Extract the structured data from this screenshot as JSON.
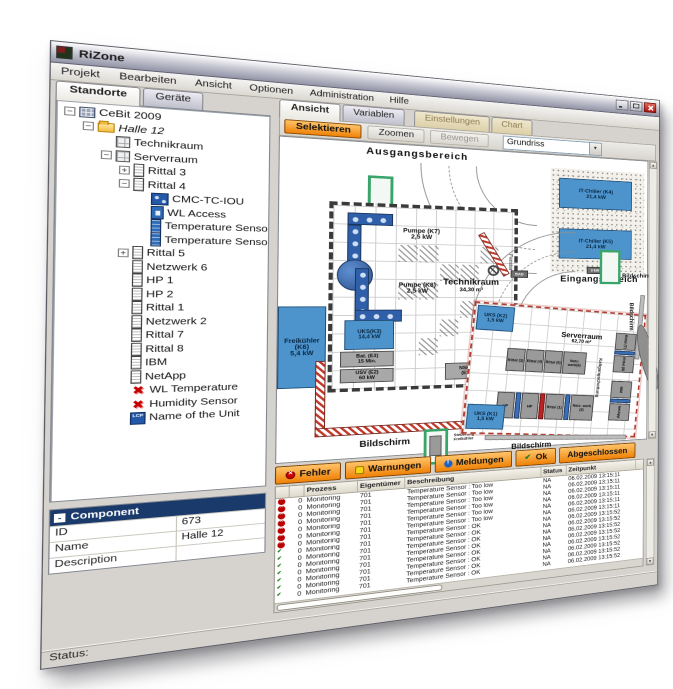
{
  "window": {
    "title": "RiZone",
    "controls": [
      "minimize-icon",
      "maximize-icon",
      "close-icon"
    ]
  },
  "menu": {
    "items": [
      "Projekt",
      "Bearbeiten",
      "Ansicht",
      "Optionen",
      "Administration",
      "Hilfe"
    ]
  },
  "left_tabs": [
    {
      "label": "Standorte"
    },
    {
      "label": "Geräte"
    }
  ],
  "tree": {
    "items": [
      {
        "label": "CeBit 2009",
        "depth": 0,
        "expander": "-",
        "icon": "site"
      },
      {
        "label": "Halle 12",
        "depth": 1,
        "expander": "-",
        "icon": "folder",
        "italic": true
      },
      {
        "label": "Technikraum",
        "depth": 2,
        "expander": null,
        "icon": "room"
      },
      {
        "label": "Serverraum",
        "depth": 2,
        "expander": "-",
        "icon": "room"
      },
      {
        "label": "Rittal 3",
        "depth": 3,
        "expander": "+",
        "icon": "rack"
      },
      {
        "label": "Rittal 4",
        "depth": 3,
        "expander": "-",
        "icon": "rack"
      },
      {
        "label": "CMC-TC-IOU",
        "depth": 4,
        "expander": null,
        "icon": "devcmc"
      },
      {
        "label": "WL Access",
        "depth": 4,
        "expander": null,
        "icon": "devwl"
      },
      {
        "label": "Temperature Sensor",
        "depth": 4,
        "expander": null,
        "icon": "devsensor"
      },
      {
        "label": "Temperature Sensor",
        "depth": 4,
        "expander": null,
        "icon": "devsensor"
      },
      {
        "label": "Rittal 5",
        "depth": 3,
        "expander": "+",
        "icon": "rack"
      },
      {
        "label": "Netzwerk 6",
        "depth": 3,
        "expander": null,
        "icon": "rack"
      },
      {
        "label": "HP 1",
        "depth": 3,
        "expander": null,
        "icon": "rack"
      },
      {
        "label": "HP 2",
        "depth": 3,
        "expander": null,
        "icon": "rack"
      },
      {
        "label": "Rittal 1",
        "depth": 3,
        "expander": null,
        "icon": "rack"
      },
      {
        "label": "Netzwerk 2",
        "depth": 3,
        "expander": null,
        "icon": "rack"
      },
      {
        "label": "Rittal 7",
        "depth": 3,
        "expander": null,
        "icon": "rack"
      },
      {
        "label": "Rittal 8",
        "depth": 3,
        "expander": null,
        "icon": "rack"
      },
      {
        "label": "IBM",
        "depth": 3,
        "expander": null,
        "icon": "rack"
      },
      {
        "label": "NetApp",
        "depth": 3,
        "expander": null,
        "icon": "rack"
      },
      {
        "label": "WL Temperature",
        "depth": 3,
        "expander": null,
        "icon": "redx"
      },
      {
        "label": "Humidity Sensor",
        "depth": 3,
        "expander": null,
        "icon": "redx"
      },
      {
        "label": "Name of the Unit",
        "depth": 3,
        "expander": null,
        "icon": "lcp"
      }
    ]
  },
  "properties": {
    "header": "Component",
    "collapse_glyph": "-",
    "rows": [
      {
        "label": "ID",
        "value": "673"
      },
      {
        "label": "Name",
        "value": "Halle 12"
      },
      {
        "label": "Description",
        "value": ""
      }
    ]
  },
  "right_tabs": [
    {
      "label": "Ansicht",
      "state": "active"
    },
    {
      "label": "Variablen",
      "state": "normal"
    },
    {
      "label": "Einstellungen",
      "state": "disabled"
    },
    {
      "label": "Chart",
      "state": "disabled"
    }
  ],
  "toolbar": {
    "selektieren": "Selektieren",
    "zoomen": "Zoomen",
    "bewegen": "Bewegen",
    "view_select": "Grundriss"
  },
  "plan": {
    "areas": {
      "ausgang": "Ausgangsbereich",
      "eingang": "Eingangsbereich"
    },
    "technikraum": {
      "name": "Technikraum",
      "size": "34,30 m²"
    },
    "serverraum": {
      "name": "Serverraum",
      "size": "62,70 m²"
    },
    "units": {
      "k7": "Pumpe (K7)\n2,5 kW",
      "k8": "Pumpe (K8)\n2,5 kW",
      "k3": "UKS(K3)\n14,4 kW",
      "k6": "Freikühler\n(K6)\n5,4 kW",
      "k4": "IT-Chiller (K4)\n21,4 kW",
      "k5": "IT-Chiller (K5)\n21,4 kW",
      "k2": "UKS (K2)\n1,5 kW",
      "k1": "UKS (K1)\n1,5 kW",
      "e3": "Bat. (E3)\n15 Min.",
      "e2": "USV (E2)\n60 kW",
      "e1": "NSHV\n(E1)",
      "e4": "PDR\n(E4)"
    },
    "racks": {
      "r3": "Rittal (3)",
      "r4": "Rittal (4)",
      "r5": "Rittal (5)",
      "n6": "Netz- werk(6)",
      "hp1": "HP",
      "hp2": "HP",
      "r1": "Rittal (1)",
      "n2": "Netz- werk (2)",
      "r7": "Rittal (7)",
      "r8": "Rittal (8)",
      "ibm": "IBM",
      "netapp": "NetApp"
    },
    "labels": {
      "bildschirm1": "Bildschirm",
      "bildschirm2": "Bildschirm",
      "bildschirm3": "Bildschirm",
      "bildschirm4": "Bildschirm",
      "fenster": "Fenster",
      "kaltgang": "Kaltgangschottung",
      "steuerung": "Steuerung\nFreikühler",
      "infostand": "Info-Stand",
      "chip1": "BAD",
      "chip2": "3 kW"
    }
  },
  "events": {
    "buttons": [
      {
        "label": "Fehler",
        "icon": "error-icon"
      },
      {
        "label": "Warnungen",
        "icon": "warning-icon"
      },
      {
        "label": "Meldungen",
        "icon": "info-icon"
      },
      {
        "label": "Ok",
        "icon": "ok-icon"
      },
      {
        "label": "Abgeschlossen",
        "icon": null
      }
    ],
    "columns": [
      "",
      "",
      "Prozess",
      "Eigentümer",
      "Beschreibung",
      "Status",
      "Zeitpunkt"
    ],
    "rows": [
      {
        "icon": "error",
        "count": "0",
        "prozess": "Monitoring",
        "eigentuemer": "701",
        "beschreibung": "Temperature Sensor : Too low",
        "status": "NA",
        "zeitpunkt": "06.02.2009 13:15:11"
      },
      {
        "icon": "error",
        "count": "0",
        "prozess": "Monitoring",
        "eigentuemer": "701",
        "beschreibung": "Temperature Sensor : Too low",
        "status": "NA",
        "zeitpunkt": "06.02.2009 13:15:11"
      },
      {
        "icon": "error",
        "count": "0",
        "prozess": "Monitoring",
        "eigentuemer": "701",
        "beschreibung": "Temperature Sensor : Too low",
        "status": "NA",
        "zeitpunkt": "06.02.2009 13:15:11"
      },
      {
        "icon": "error",
        "count": "0",
        "prozess": "Monitoring",
        "eigentuemer": "701",
        "beschreibung": "Temperature Sensor : Too low",
        "status": "NA",
        "zeitpunkt": "06.02.2009 13:15:11"
      },
      {
        "icon": "error",
        "count": "0",
        "prozess": "Monitoring",
        "eigentuemer": "701",
        "beschreibung": "Temperature Sensor : Too low",
        "status": "NA",
        "zeitpunkt": "06.02.2009 13:15:11"
      },
      {
        "icon": "error",
        "count": "0",
        "prozess": "Monitoring",
        "eigentuemer": "701",
        "beschreibung": "Temperature Sensor : Too low",
        "status": "NA",
        "zeitpunkt": "06.02.2009 13:15:11"
      },
      {
        "icon": "error",
        "count": "0",
        "prozess": "Monitoring",
        "eigentuemer": "701",
        "beschreibung": "Temperature Sensor : OK",
        "status": "NA",
        "zeitpunkt": "06.02.2009 13:15:52"
      },
      {
        "icon": "ok",
        "count": "0",
        "prozess": "Monitoring",
        "eigentuemer": "701",
        "beschreibung": "Temperature Sensor : OK",
        "status": "NA",
        "zeitpunkt": "06.02.2009 13:15:52"
      },
      {
        "icon": "ok",
        "count": "0",
        "prozess": "Monitoring",
        "eigentuemer": "701",
        "beschreibung": "Temperature Sensor : OK",
        "status": "NA",
        "zeitpunkt": "06.02.2009 13:15:52"
      },
      {
        "icon": "ok",
        "count": "0",
        "prozess": "Monitoring",
        "eigentuemer": "701",
        "beschreibung": "Temperature Sensor : OK",
        "status": "NA",
        "zeitpunkt": "06.02.2009 13:15:52"
      },
      {
        "icon": "ok",
        "count": "0",
        "prozess": "Monitoring",
        "eigentuemer": "701",
        "beschreibung": "Temperature Sensor : OK",
        "status": "NA",
        "zeitpunkt": "06.02.2009 13:15:52"
      },
      {
        "icon": "ok",
        "count": "0",
        "prozess": "Monitoring",
        "eigentuemer": "701",
        "beschreibung": "Temperature Sensor : OK",
        "status": "NA",
        "zeitpunkt": "06.02.2009 13:15:52"
      },
      {
        "icon": "ok",
        "count": "0",
        "prozess": "Monitoring",
        "eigentuemer": "701",
        "beschreibung": "Temperature Sensor : OK",
        "status": "NA",
        "zeitpunkt": "06.02.2009 13:15:52"
      },
      {
        "icon": "ok",
        "count": "0",
        "prozess": "Monitoring",
        "eigentuemer": "701",
        "beschreibung": "Temperature Sensor : OK",
        "status": "NA",
        "zeitpunkt": "06.02.2009 13:15:52"
      }
    ]
  },
  "status_bar": {
    "label": "Status:"
  }
}
